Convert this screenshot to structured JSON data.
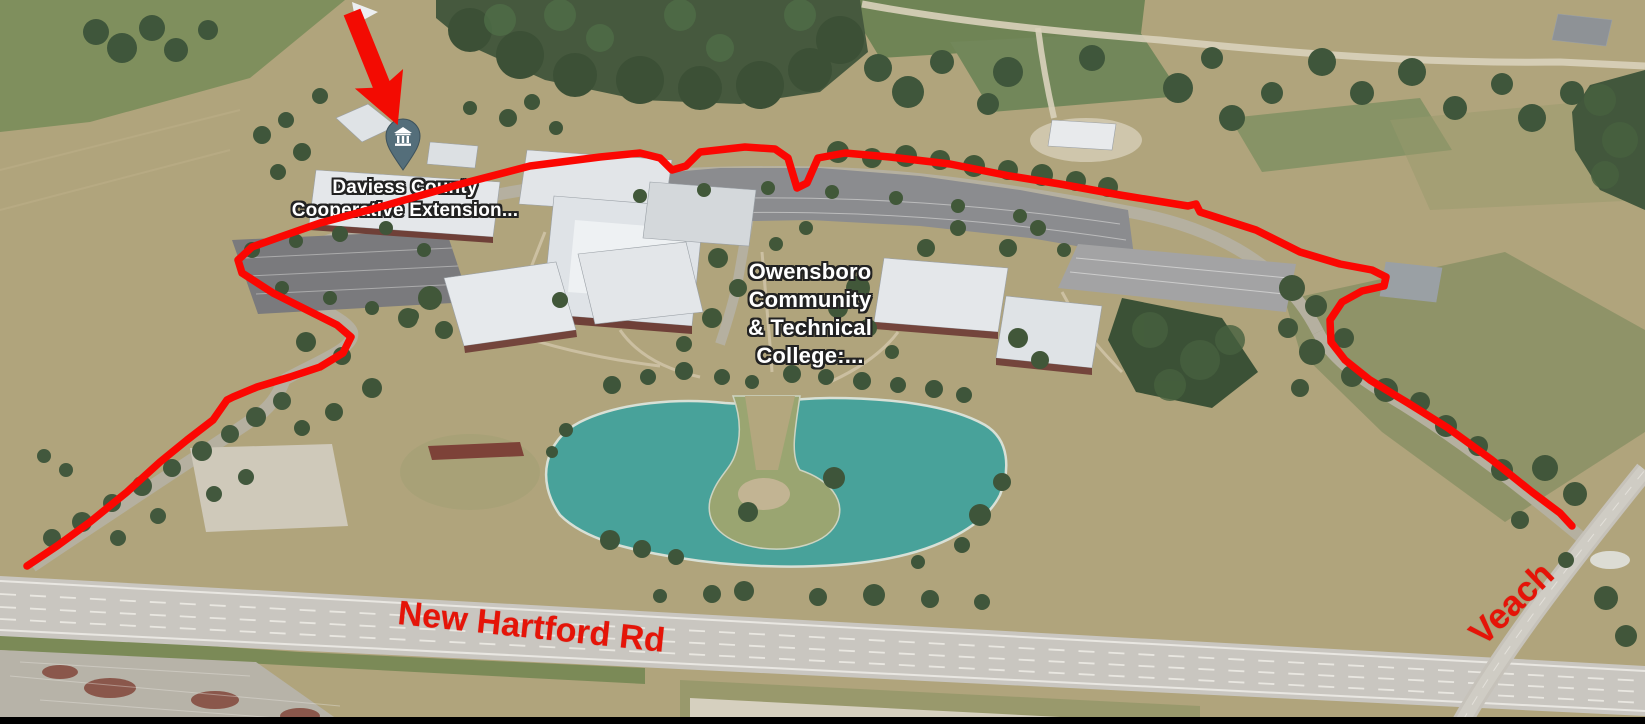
{
  "map": {
    "poi_label": {
      "line1": "Daviess County",
      "line2": "Cooperative Extension..."
    },
    "campus_label": {
      "line1": "Owensboro",
      "line2": "Community",
      "line3": "& Technical",
      "line4": "College:..."
    },
    "road_labels": {
      "main": "New Hartford Rd",
      "side": "Veach"
    },
    "marker": {
      "icon": "institution-pin",
      "color": "#546e7a"
    }
  },
  "annotations": {
    "arrow_icon": "red-direction-arrow",
    "route_outline": "red-route-around-campus",
    "text_color": "#e51408",
    "route_color": "#fb0702"
  },
  "scene_colors": {
    "pond": "#48a29a",
    "dry_grass": "#b0a47c",
    "green_field": "#7f8f5d",
    "trees": "#42573c",
    "road": "#c9c6c0",
    "roof_white": "#e6e9ec"
  }
}
